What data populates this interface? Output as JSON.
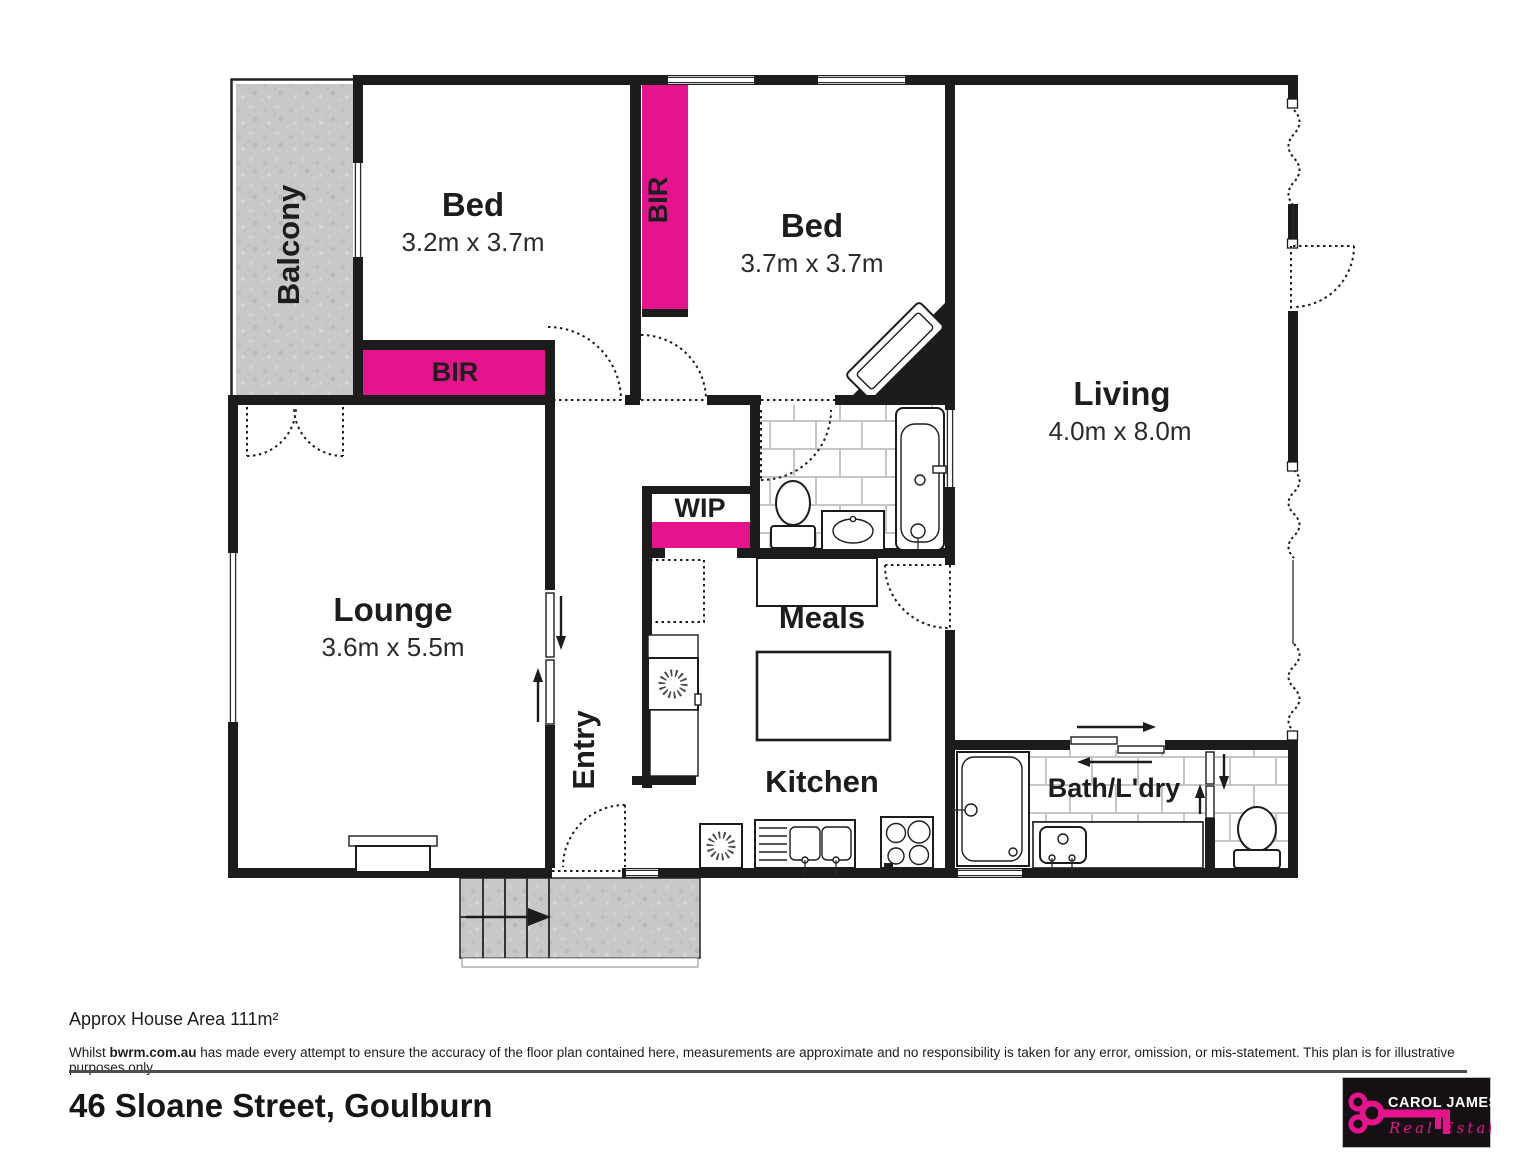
{
  "plan": {
    "rooms": {
      "balcony": {
        "name": "Balcony"
      },
      "bed1": {
        "name": "Bed",
        "dims": "3.2m x 3.7m"
      },
      "bed2": {
        "name": "Bed",
        "dims": "3.7m x 3.7m"
      },
      "living": {
        "name": "Living",
        "dims": "4.0m x 8.0m"
      },
      "lounge": {
        "name": "Lounge",
        "dims": "3.6m x 5.5m"
      },
      "meals": {
        "name": "Meals"
      },
      "kitchen": {
        "name": "Kitchen"
      },
      "entry": {
        "name": "Entry"
      },
      "wip": {
        "name": "WIP"
      },
      "bath_laundry": {
        "name": "Bath/L'dry"
      },
      "bir_bed1": {
        "name": "BIR"
      },
      "bir_bed2": {
        "name": "BIR"
      }
    },
    "colors": {
      "robe_pink": "#e6148c",
      "wall_black": "#1c1c1c",
      "concrete_gray": "#c8c8c8"
    }
  },
  "footer": {
    "area_note": "Approx House Area 111m²",
    "disclaimer": {
      "prefix": "Whilst ",
      "brand": "bwrm.com.au",
      "suffix": " has made every attempt to ensure the accuracy of the floor plan contained here, measurements are approximate and no responsibility is taken for any error, omission, or mis-statement. This plan is for illustrative purposes only."
    },
    "address": "46 Sloane Street, Goulburn"
  },
  "logo": {
    "line1": "CAROL JAMES",
    "line2": "Real Estate"
  }
}
